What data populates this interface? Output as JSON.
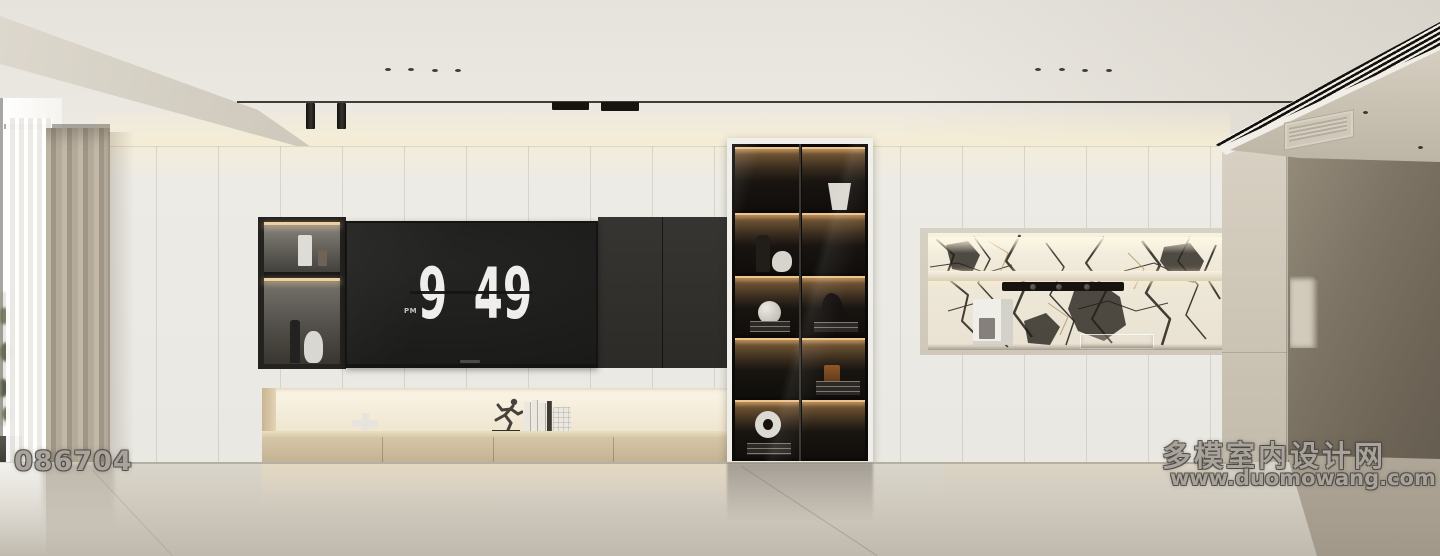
{
  "watermark": {
    "site_name": "多模室内设计网",
    "site_url": "www.duomowang.com",
    "image_id": "086704"
  },
  "tv": {
    "clock_hour": "9",
    "clock_minute": "49",
    "clock_meridiem": "PM"
  },
  "decor": {
    "left_niche_items": [
      "white-cylinder-vase",
      "small-glass",
      "dark-bottle",
      "white-round-vase"
    ],
    "bench_items": [
      "cross-sculpture",
      "runner-figurine",
      "white-books",
      "lantern-vase"
    ],
    "cabinet_items": [
      "white-vase",
      "dark-vase",
      "white-jug",
      "sphere-vase-on-books",
      "abstract-sculpture-on-books",
      "amber-glass-on-books",
      "ring-vase-on-books"
    ],
    "marble_niche_items": [
      "coffee-machine",
      "control-bar",
      "glass-tray"
    ]
  },
  "palette": {
    "wall_white": "#edebe5",
    "ceiling": "#e8e5df",
    "cove_glow": "#f6edd2",
    "dark_panel": "#31302d",
    "tv_screen": "#1c1c1b",
    "clock_digits": "#efeeec",
    "wood_bench": "#d3c3a4",
    "cabinet_black": "#16130f",
    "led_warm": "#eec489",
    "marble_white": "#efe9dc",
    "marble_vein": "#23201a",
    "curtain_taupe": "#b2a896",
    "corridor_shadow": "#756c5e",
    "floor": "#dbd6cc"
  }
}
